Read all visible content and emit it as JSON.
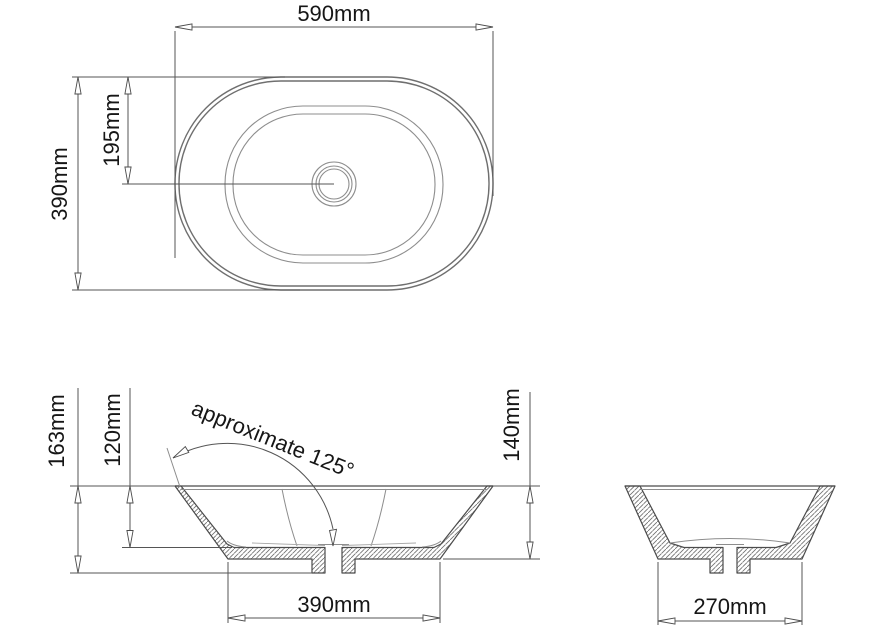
{
  "meta": {
    "title": "Oval basin technical drawing with dimensions"
  },
  "canvas": {
    "w": 891,
    "h": 629,
    "bg": "#ffffff",
    "line_color": "#4b4b4b",
    "text_color": "#161616"
  },
  "dimensions_summary": {
    "plan_length": "590mm",
    "plan_width": "390mm",
    "plan_center_offset": "195mm",
    "overall_height": "163mm",
    "bowl_depth": "120mm",
    "rim_to_base_height": "140mm",
    "base_length": "390mm",
    "base_width": "270mm",
    "wall_angle": "approximate 125°"
  },
  "labels": [
    {
      "id": "dim-label-590",
      "text": "590mm",
      "x": 334,
      "y": 21,
      "rot": 0,
      "anchor": "middle"
    },
    {
      "id": "dim-label-390-plan",
      "text": "390mm",
      "x": 67,
      "y": 184,
      "rot": -90,
      "anchor": "middle"
    },
    {
      "id": "dim-label-195",
      "text": "195mm",
      "x": 119,
      "y": 130,
      "rot": -90,
      "anchor": "middle"
    },
    {
      "id": "dim-label-163",
      "text": "163mm",
      "x": 64,
      "y": 431,
      "rot": -90,
      "anchor": "middle"
    },
    {
      "id": "dim-label-120",
      "text": "120mm",
      "x": 120,
      "y": 430,
      "rot": -90,
      "anchor": "middle"
    },
    {
      "id": "angle-label",
      "text": "approximate 125°",
      "x": 190,
      "y": 414,
      "rot": 22,
      "anchor": "start"
    },
    {
      "id": "dim-label-140",
      "text": "140mm",
      "x": 519,
      "y": 425,
      "rot": -90,
      "anchor": "middle"
    },
    {
      "id": "dim-label-390-base",
      "text": "390mm",
      "x": 334,
      "y": 612,
      "rot": 0,
      "anchor": "middle"
    },
    {
      "id": "dim-label-270",
      "text": "270mm",
      "x": 730,
      "y": 614,
      "rot": 0,
      "anchor": "middle"
    }
  ],
  "views": [
    {
      "name": "plan-view",
      "rounded_rects": [
        {
          "x": 175,
          "y": 77,
          "w": 318,
          "h": 213,
          "r": 106,
          "cls": "oval"
        },
        {
          "x": 179,
          "y": 81,
          "w": 310,
          "h": 205,
          "r": 102,
          "cls": "oval"
        },
        {
          "x": 225,
          "y": 106,
          "w": 218,
          "h": 157,
          "r": 78,
          "cls": "oval2"
        },
        {
          "x": 233,
          "y": 114,
          "w": 202,
          "h": 141,
          "r": 70,
          "cls": "oval2"
        }
      ],
      "circles": [
        {
          "cx": 334,
          "cy": 184,
          "r": 22,
          "cls": "oval2"
        },
        {
          "cx": 334,
          "cy": 184,
          "r": 18,
          "cls": "oval2"
        },
        {
          "cx": 334,
          "cy": 184,
          "r": 15,
          "cls": "oval2"
        }
      ],
      "lines": [
        [
          175,
          27,
          493,
          27,
          "dim"
        ],
        [
          175,
          31,
          175,
          258,
          "dim"
        ],
        [
          493,
          31,
          493,
          196,
          "dim"
        ],
        [
          72,
          77,
          285,
          77,
          "dim"
        ],
        [
          72,
          290,
          300,
          290,
          "dim"
        ],
        [
          78,
          77,
          78,
          290,
          "dim"
        ],
        [
          128,
          77,
          128,
          184,
          "dim"
        ],
        [
          122,
          184,
          334,
          184,
          "dim"
        ]
      ],
      "paths": [],
      "polys": [],
      "arrows": [
        "175,27 192,23.9 192,30.1",
        "493,27 476,23.9 476,30.1",
        "78,77 74.9,94 81.1,94",
        "78,290 74.9,273 81.1,273",
        "128,77 124.9,94 131.1,94",
        "128,184 124.9,167 131.1,167"
      ],
      "label_ids": [
        0,
        1,
        2
      ]
    },
    {
      "name": "front-elevation-view",
      "rounded_rects": [],
      "circles": [],
      "lines": [
        [
          70,
          486,
          175,
          486,
          "dim"
        ],
        [
          493,
          486,
          540,
          486,
          "dim"
        ],
        [
          175,
          486,
          493,
          486,
          "outline"
        ],
        [
          181,
          489.5,
          487,
          489.5,
          "thin"
        ],
        [
          318,
          544.5,
          349,
          544.5,
          "thin"
        ],
        [
          122,
          547.5,
          232,
          547.5,
          "dim"
        ],
        [
          443,
          559,
          540,
          559,
          "dim"
        ],
        [
          70,
          573,
          312,
          573,
          "dim"
        ],
        [
          78,
          388,
          78,
          573,
          "dim"
        ],
        [
          130,
          388,
          130,
          547.5,
          "dim"
        ],
        [
          530,
          392,
          530,
          559,
          "dim"
        ],
        [
          228,
          562,
          228,
          623,
          "dim"
        ],
        [
          440,
          562,
          440,
          623,
          "dim"
        ],
        [
          228,
          618,
          440,
          618,
          "dim"
        ],
        [
          167,
          448,
          180,
          487,
          "thin"
        ]
      ],
      "paths": [
        [
          "M282,489 Q288,520 297,546",
          "thin"
        ],
        [
          "M386,489 Q380,520 371,546",
          "thin"
        ],
        [
          "M227,541 Q233,546 246,547",
          "thin"
        ],
        [
          "M441,541 Q435,546 422,547",
          "thin"
        ],
        [
          "M252,543 L325,545.5",
          "thin2"
        ],
        [
          "M416,543 L342,545.5",
          "thin2"
        ],
        [
          "M173,458 A108,108 0 0 1 333,529",
          "dim"
        ]
      ],
      "polys": [
        "175,486 228,559 312,559 312,573 325,573 325,547.5 234,547.5 227,544 181,486",
        "493,486 440,559 355,559 355,573 342,573 342,547.5 434,547.5 441,544 487,486"
      ],
      "arrows": [
        "78,486 74.9,503 81.1,503",
        "78,573 74.9,556 81.1,556",
        "130,486 126.9,503 133.1,503",
        "130,547.5 126.9,530.5 133.1,530.5",
        "530,486 526.9,503 533.1,503",
        "530,559 526.9,542 533.1,542",
        "228,618 245,614.9 245,621.1",
        "440,618 423,614.9 423,621.1",
        "173,458 188.8,452.4 185.3,446.6",
        "333,546 336.5,529.3 329.5,530.5"
      ],
      "label_ids": [
        3,
        4,
        5,
        6,
        7
      ]
    },
    {
      "name": "side-elevation-view",
      "rounded_rects": [],
      "circles": [],
      "lines": [
        [
          625,
          486,
          835,
          486,
          "outline"
        ],
        [
          640,
          489.5,
          820,
          489.5,
          "thin"
        ],
        [
          716,
          544.5,
          744,
          544.5,
          "thin"
        ],
        [
          658,
          562,
          658,
          625,
          "dim"
        ],
        [
          802,
          562,
          802,
          625,
          "dim"
        ],
        [
          658,
          621,
          802,
          621,
          "dim"
        ]
      ],
      "paths": [
        [
          "M670,543 Q730,534 790,543",
          "thin"
        ]
      ],
      "polys": [
        "625,486 658,559 710,559 710,573 723,573 723,547.5 684,547.5 670,543 640,486",
        "835,486 802,559 750,559 750,573 737,573 737,547.5 776,547.5 790,543 820,486"
      ],
      "arrows": [
        "658,621 675,617.9 675,624.1",
        "802,621 785,617.9 785,624.1"
      ],
      "label_ids": [
        8
      ]
    }
  ]
}
